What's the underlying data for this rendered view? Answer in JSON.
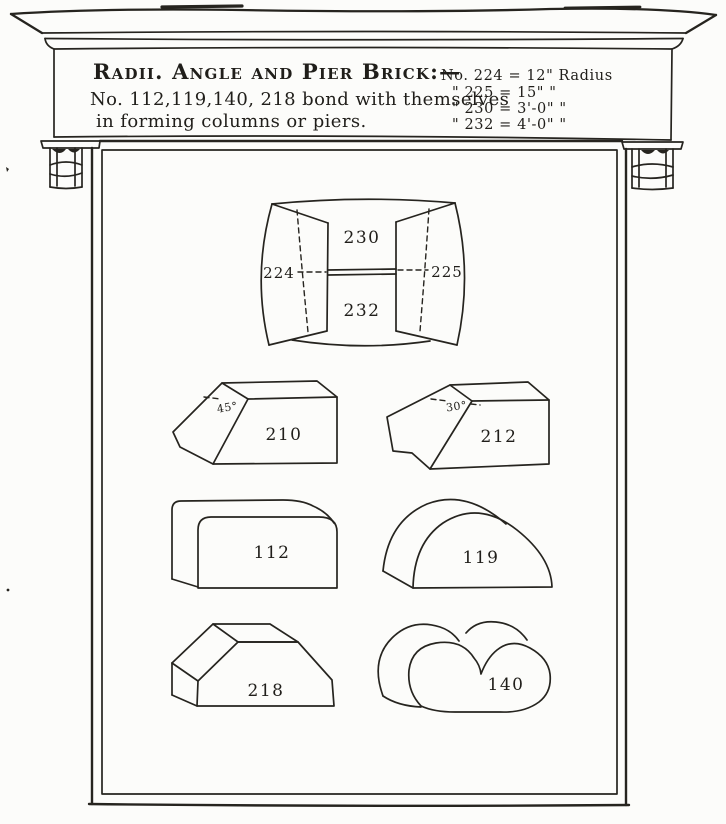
{
  "header": {
    "title": "Radii. Angle and Pier Brick:—",
    "note_line1": "No. 112,119,140, 218 bond with themselves",
    "note_line2": "in forming columns or piers.",
    "radius_rows": [
      "No. 224 = 12\" Radius",
      "\"  225 = 15\"   \"",
      "\"  230 = 3'-0\"  \"",
      "\"  232 = 4'-0\"  \""
    ]
  },
  "figures": {
    "radial": {
      "top": "230",
      "bottom": "232",
      "left": "224",
      "right": "225"
    },
    "angle45": {
      "label": "210",
      "angle": "45°"
    },
    "angle30": {
      "label": "212",
      "angle": "30°"
    },
    "bullnose": {
      "label": "112"
    },
    "halfround": {
      "label": "119"
    },
    "chamfer": {
      "label": "218"
    },
    "double_bullnose": {
      "label": "140"
    }
  },
  "colors": {
    "ink": "#26241f",
    "paper": "#fcfcfa"
  }
}
